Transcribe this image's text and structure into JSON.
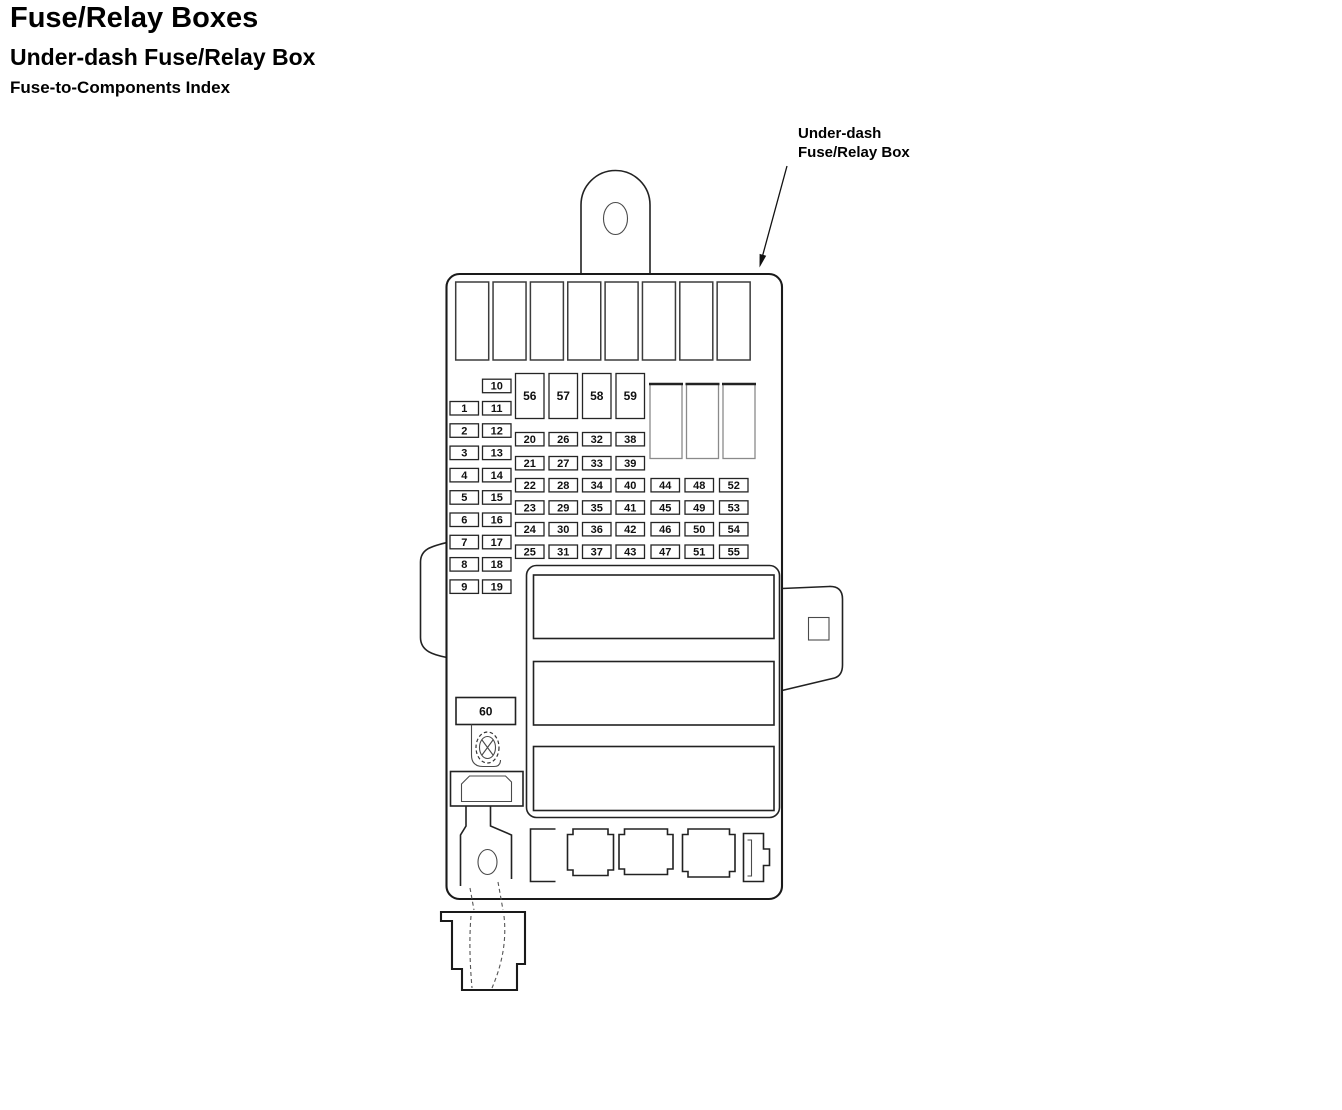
{
  "page": {
    "title": "Fuse/Relay Boxes",
    "subtitle": "Under-dash Fuse/Relay Box",
    "section_heading": "Fuse-to-Components Index"
  },
  "callout": {
    "line1": "Under-dash",
    "line2": "Fuse/Relay Box"
  },
  "colors": {
    "background": "#ffffff",
    "line": "#1a1a1a",
    "text": "#000000"
  },
  "fuse_box": {
    "left_column_outer": [
      "1",
      "2",
      "3",
      "4",
      "5",
      "6",
      "7",
      "8",
      "9"
    ],
    "left_column_inner": [
      "10",
      "11",
      "12",
      "13",
      "14",
      "15",
      "16",
      "17",
      "18",
      "19"
    ],
    "large_fuses": [
      "56",
      "57",
      "58",
      "59"
    ],
    "fuse_grid_rows": [
      [
        "20",
        "26",
        "32",
        "38"
      ],
      [
        "21",
        "27",
        "33",
        "39"
      ],
      [
        "22",
        "28",
        "34",
        "40",
        "44",
        "48",
        "52"
      ],
      [
        "23",
        "29",
        "35",
        "41",
        "45",
        "49",
        "53"
      ],
      [
        "24",
        "30",
        "36",
        "42",
        "46",
        "50",
        "54"
      ],
      [
        "25",
        "31",
        "37",
        "43",
        "47",
        "51",
        "55"
      ]
    ],
    "bottom_fuse": "60",
    "top_relay_slots": 8,
    "right_relay_slots": 3
  }
}
